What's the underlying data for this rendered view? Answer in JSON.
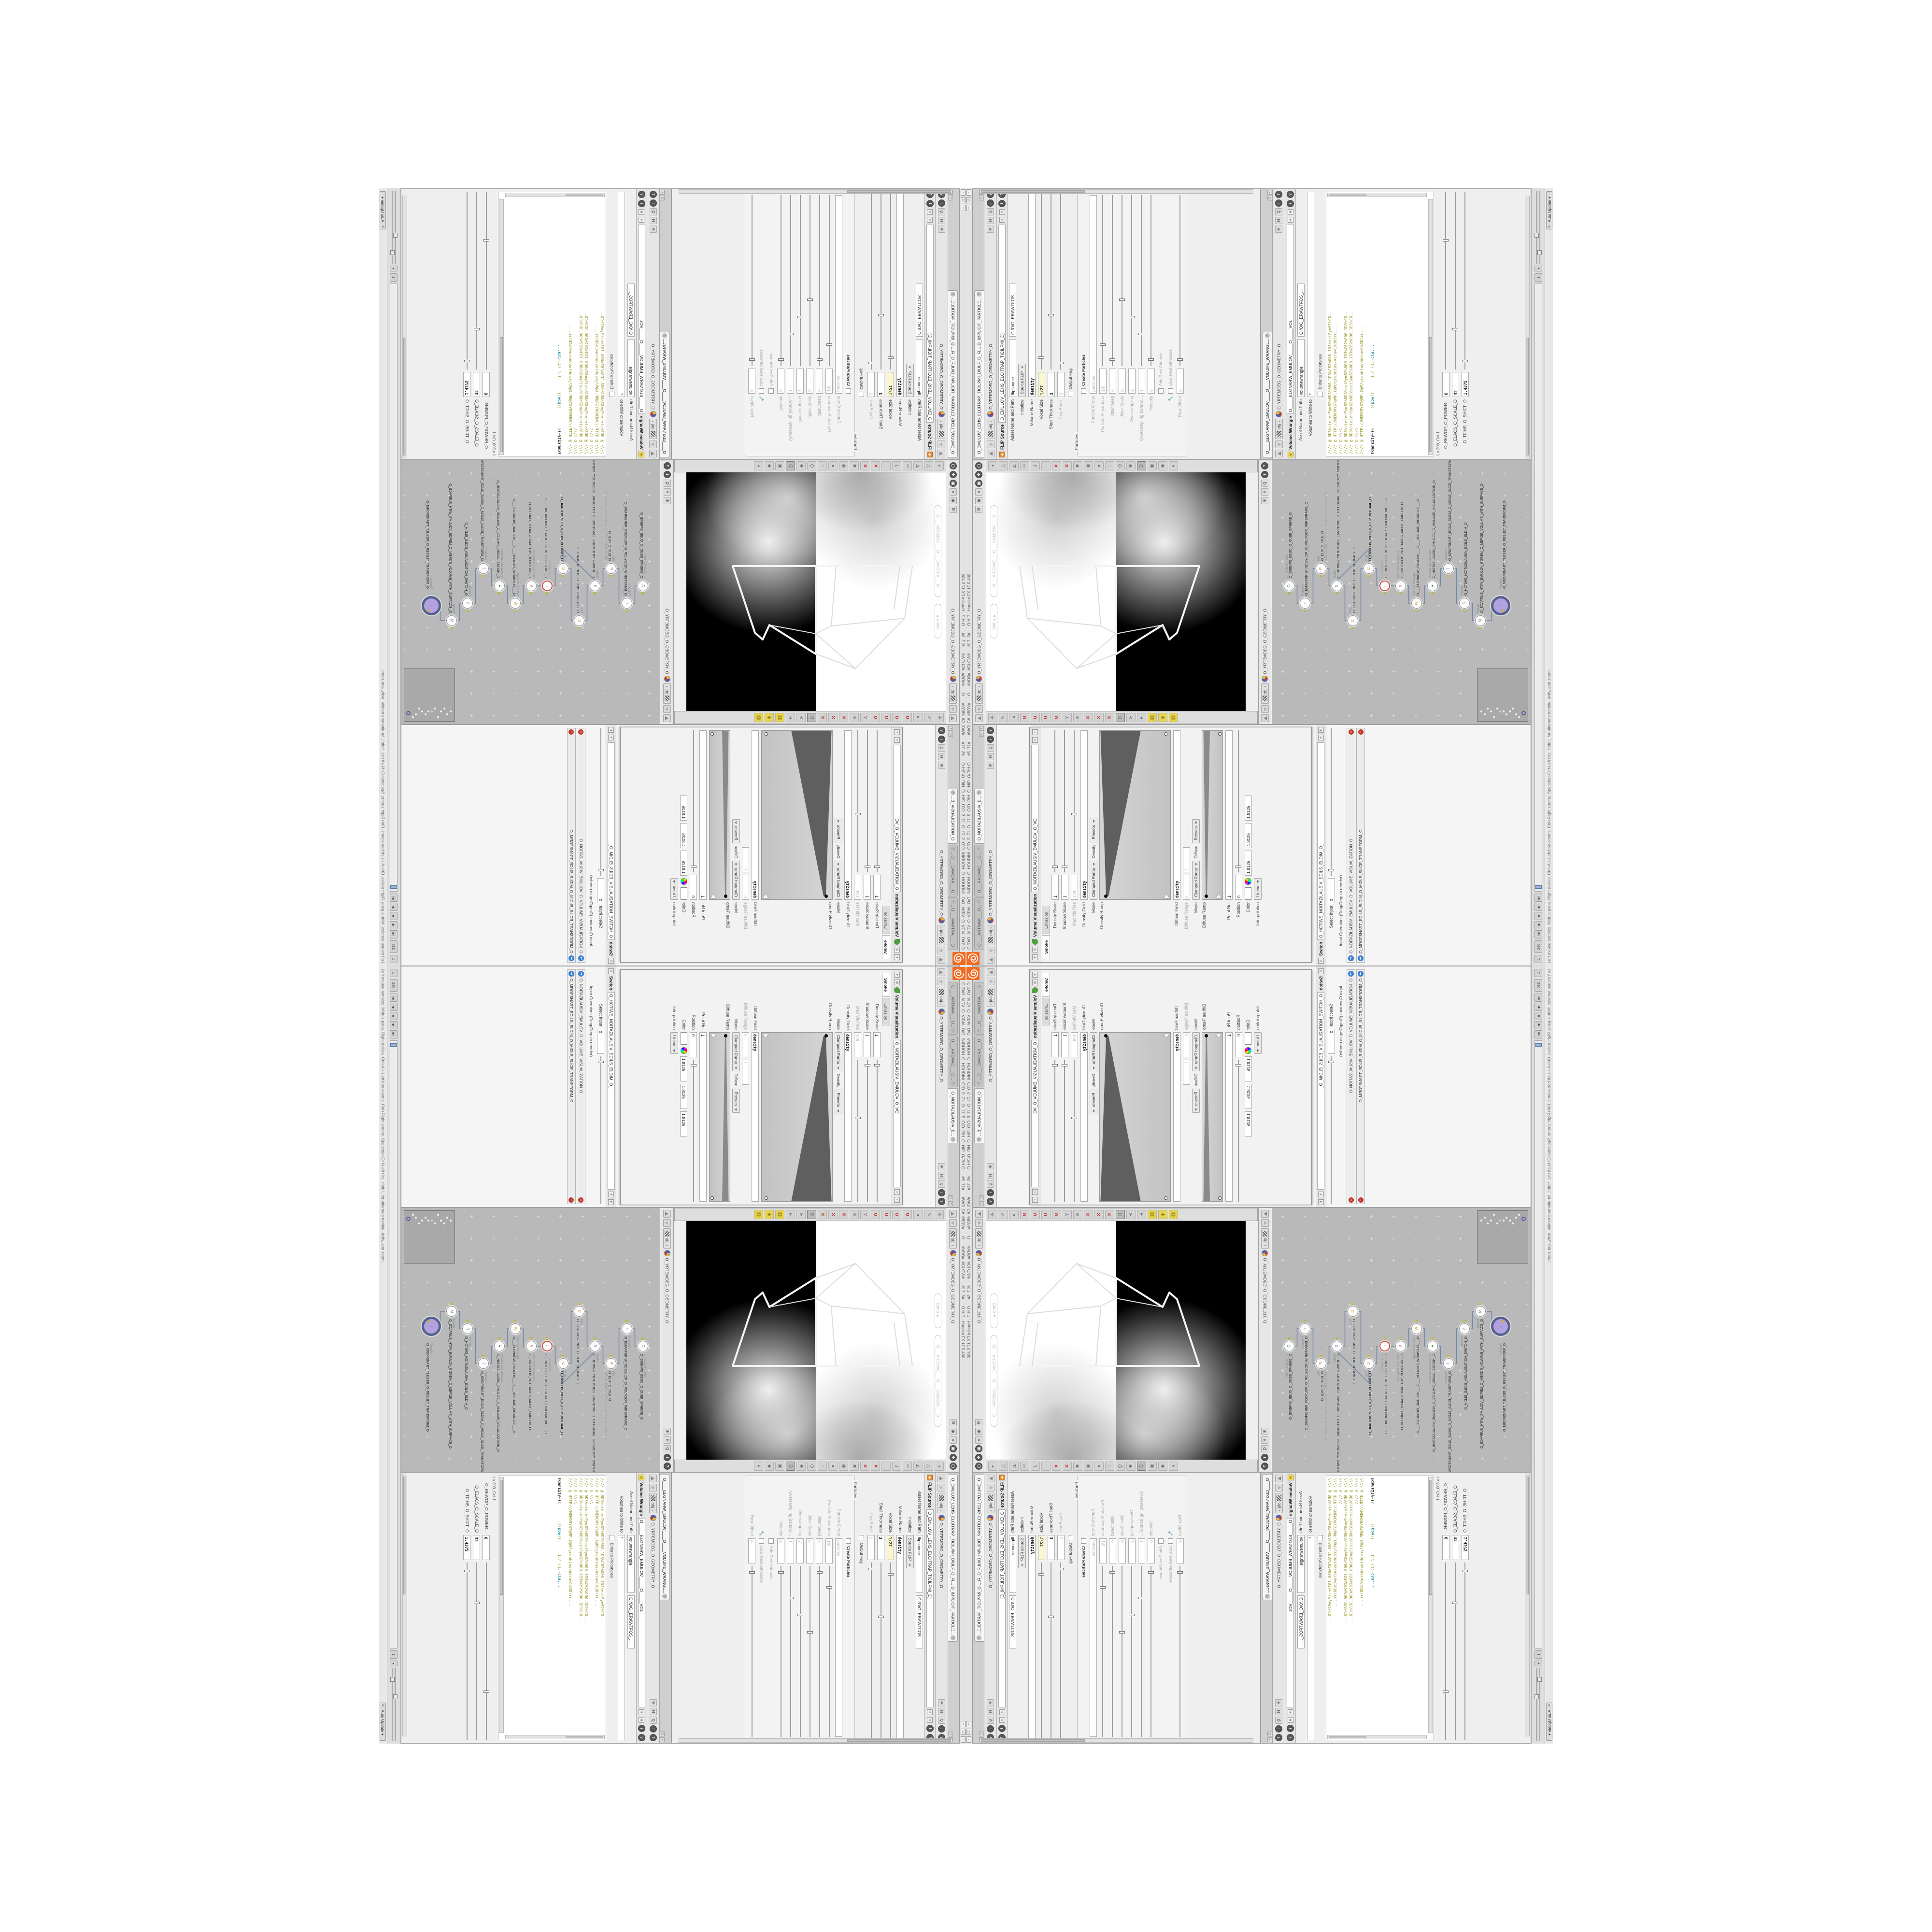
{
  "window": {
    "title": "C:/O/O_AIDV_O_VIDIA_O/O_INIDUOH_O_HOUDINI_O/O_5_71_O_17_5_O/O_PIH_O_HIP_O/PIH.O___#5_71#___#WOLG#_#BDV#___O___#VDB#_#GLOW#___#17_5#___O.HIP - Houdini FX 17.5.480",
    "buttons": {
      "min": "–",
      "max": "▢",
      "close": "×"
    },
    "logo": "houdini-logo"
  },
  "status": {
    "help": "Left mouse tumbles.  Middle pans.  Right dollies.  Ctrl+Alt+Left box-zooms.  Ctrl+Right zooms.  Spacebar-Ctrl-Left tilts.  Hold L for alternate tumble, dolly, and zoom.",
    "auto_update": "Auto Update"
  },
  "playbar": {
    "start": "1",
    "end": "240",
    "current": "1",
    "transport": [
      "|◀",
      "◀",
      "■",
      "▶",
      "▶|"
    ]
  },
  "breadcrumb": {
    "net": "obj",
    "node": "O_YRTEMOEG_O_GEOMETRY_O",
    "pin": "*"
  },
  "pane_icons": [
    "✳",
    "H",
    "Q",
    "i",
    "?"
  ],
  "left_pane": {
    "tabs": [
      {
        "label": "O ___ARTNAM___O...",
        "active": false
      },
      {
        "label": "O___AREMAC___O...",
        "active": false
      },
      {
        "label": "O_NOITAZILAUSIV_E...",
        "active": true
      }
    ],
    "vv_window": {
      "title": "Volume Visualization",
      "name_field": "O_NOITAZILAUSIV_EMULOV_O_VO",
      "tabs": [
        "Smoke",
        "Emission"
      ],
      "rows": [
        {
          "t": "fs",
          "label": "Density Scale",
          "value": "1",
          "p": 3
        },
        {
          "t": "fs",
          "label": "Shadow Scale",
          "value": "1",
          "p": 3
        },
        {
          "t": "fs",
          "label": "Max Vis Res",
          "value": "128",
          "dis": true,
          "p": 40
        },
        {
          "t": "fv",
          "label": "Density Field",
          "value": "density",
          "bold": true
        },
        {
          "t": "mode",
          "label": "Mode",
          "value": "Clamped Ramp",
          "mid": "Density",
          "btn": "Presets"
        },
        {
          "t": "ramp",
          "label": "Density Ramp",
          "h": 148,
          "big": true
        },
        {
          "t": "fv",
          "label": "Diffuse Field",
          "value": "density",
          "bold": true
        },
        {
          "t": "f2",
          "label": "Diffuse Range",
          "v1": "0",
          "v2": "1",
          "dis": true
        },
        {
          "t": "mode",
          "label": "Mode",
          "value": "Clamped Ramp",
          "mid": "Diffuse",
          "btn": "Presets"
        },
        {
          "t": "ramp",
          "label": "Diffuse Ramp",
          "h": 44,
          "big": false
        },
        {
          "t": "fv",
          "label": "Point No.",
          "value": "1"
        },
        {
          "t": "fs",
          "label": "Position",
          "value": "0",
          "p": 3
        },
        {
          "t": "color",
          "label": "Color",
          "r": "1.8125",
          "g": "1.8125",
          "b": "1.8125"
        },
        {
          "t": "sel",
          "label": "Interpolation",
          "value": "Linear"
        }
      ]
    },
    "switch_section": {
      "title": "Switch",
      "name_field": "O_HCTIWS_NOITAZILAUSIV_ECILS_ELDIM_O_",
      "rows": [
        {
          "t": "fs",
          "label": "Select Input",
          "value": "0",
          "p": 3
        },
        {
          "t": "label",
          "label": "Input Operators (Drag/Drop to reorder)"
        },
        {
          "t": "oprow",
          "label": "O_NOITAZILAUSIV_EMULOV_O_VOLUME_VISUALIZATION_O"
        },
        {
          "t": "oprow",
          "label": "O_MROFSNART_ECILS_ELDIM_O_MIDLE_SLICE_TRANSFORM_O"
        }
      ]
    }
  },
  "viewport": {
    "view_pill": "Ortho ▾",
    "camera_pill": "O___AREMAC___O___CAMERA___O",
    "right_icon_stack": [
      "⚒",
      "◉",
      "●",
      "▣",
      "❖",
      "▢"
    ],
    "left_tools": [
      "✇",
      "✎",
      "◂",
      "∪",
      "∪",
      "∪",
      "∪",
      "Y",
      "✳",
      "✕",
      "✕",
      "✕",
      "D",
      "➤",
      "▸",
      "▥",
      "◈",
      "▥"
    ],
    "right_tools": [
      "◂",
      "△",
      "◭",
      "✂",
      "⚷",
      "·",
      "✕",
      "✕",
      "✹",
      "◉",
      "●",
      "○",
      "Q",
      "✹",
      "D",
      "▣",
      "◆",
      "▸"
    ]
  },
  "network": {
    "nodes": [
      {
        "type": "an_CubeSphere",
        "name": "O_EREHPS_EBUC_O_CUBE_SPHERE_O",
        "icon": "G",
        "c": "#3f9e4f",
        "lane": 1
      },
      {
        "type": "PolyWire",
        "name": "O_EMARFERIW_NOGYLOP_O_POLYGON_WIREFRAME_O",
        "icon": "+",
        "c": "#888",
        "lane": 0
      },
      {
        "type": "File",
        "name": "O_ELIF_O_FILE_O",
        "sub": "JRO.NO1.PETS.TRIPL5_O_5LPIRT.STEP.1ON.ORJ",
        "icon": "F",
        "c": "#c44e3c",
        "lane": 2
      },
      {
        "type": "Switch",
        "name": "O_HCTIWS_YRTEMOEG_LANRETXE_O_EXTERNAL_GEOMETRY_SWITCH_O",
        "icon": "S",
        "c": "#888",
        "lane": 1
      },
      {
        "type": "Clip",
        "name": "O_ECAFRUS_PILC_O_CLIP_SURFACE_O",
        "icon": "C",
        "c": "#e08a2e",
        "lane": -1
      },
      {
        "type": "Clip",
        "name": "O_EMULOV_PILC_O_CLIP_VOLUME_O",
        "icon": "C",
        "c": "#e08a2e",
        "lane": 2,
        "bold": true
      },
      {
        "type": "FLIP Source",
        "name": "O_EMULOV_LEHS_ELCITRAP_TICILPMI_DIULF_O",
        "icon": "◌",
        "c": "#cf4f44",
        "lane": 1,
        "redring": true
      },
      {
        "type": "VDB from Polygons",
        "name": "O_SNOGILOP_YRTEMOEG_MORF_EMULOV_O",
        "icon": "V",
        "c": "#c44e3c",
        "lane": 1
      },
      {
        "type": "Volume Wrangle",
        "name": "O___ELGNARW_EMULOV___O___VOLUME_WRANGLE___O",
        "icon": "W",
        "c": "#b8a12c",
        "lane": 0
      },
      {
        "type": "Volume Visualization",
        "name": "O_NOITAZILAUSIV_EMULOV_O_VOLUME_VISUALIZATION_O",
        "icon": "●",
        "c": "#3f7e3f",
        "lane": 1
      },
      {
        "type": "Transform",
        "name": "O_MROFSNART_ECILS_ELDIM_O_MIDLE_SLICE_TRANSFORM_O",
        "icon": "T",
        "c": "#6a7fc0",
        "lane": 2
      },
      {
        "type": "Switch",
        "name": "O_HCTIWS_NOITAZILAUSIV_ECILS_ELDIM_O",
        "icon": "S",
        "c": "#888",
        "lane": 0
      },
      {
        "type": "Merge",
        "name": "O_ECAFRUS_HTIW_EMULOV_EGREM_O_MERGE_VOLUME_WITH_SURFACE_O",
        "icon": "M",
        "c": "#888",
        "lane": -1
      },
      {
        "type": "Transform",
        "name": "O_MROFSNART_TLUSER_O_RESULT_TRANSFORM_O",
        "icon": "T",
        "c": "#6a7fc0",
        "lane": 0,
        "big": true
      }
    ]
  },
  "flip_pane": {
    "tab": "O_EMULOV_LEHS_ELCITRAP_TICILPMI_DIULF_O_FLUID_IMPLICIT_PARTICLE...",
    "title": "FLIP Source",
    "name_field": "O_EMULOV_LEHS_ELCITRAP_TICILPMI_D]",
    "asset_label": "Asset Name and Path",
    "asset_name": "flipsource",
    "asset_path": "C:/O/O_ERAWTFOS_...",
    "rows": [
      {
        "t": "sel",
        "label": "Initialize",
        "value": "Source FLIP"
      },
      {
        "t": "fv",
        "label": "Volume Name",
        "value": "density",
        "bold": true
      },
      {
        "t": "fs",
        "label": "Voxel Size",
        "value": "1/27",
        "bold": true,
        "expr": true,
        "p": 6
      },
      {
        "t": "fs",
        "label": "Shell Thickness",
        "value": "3",
        "bold": true,
        "p": 30
      },
      {
        "t": "fs",
        "label": "Fog Boost",
        "value": "0",
        "dis": true,
        "p": 3
      },
      {
        "t": "check",
        "label": "Output Fog",
        "on": false
      }
    ],
    "group_title": "Particles",
    "group_rows": [
      {
        "t": "check",
        "label": "Create Particles",
        "on": false,
        "bold": true
      },
      {
        "t": "fv",
        "label": "Particle Group",
        "value": "particles",
        "dis": true
      },
      {
        "t": "fs",
        "label": "Particle Separation",
        "value": "1/9",
        "dis": true,
        "p": 12
      },
      {
        "t": "fs",
        "label": "Jitter Seed",
        "value": "0",
        "dis": true,
        "p": 3
      },
      {
        "t": "fs",
        "label": "Jitter Scale",
        "value": "0",
        "dis": true,
        "p": 38
      },
      {
        "t": "fs",
        "label": "Oversampling",
        "value": "2",
        "dis": true,
        "p": 28
      },
      {
        "t": "fs",
        "label": "Oversampling Bandwi...",
        "value": "1",
        "dis": true,
        "p": 18
      },
      {
        "t": "fs",
        "label": "Velocity",
        "value": "0",
        "dis": true,
        "p": 3
      },
      {
        "t": "check",
        "label": "Add Rest Attribute",
        "on": false,
        "dis": true
      },
      {
        "t": "check",
        "label": "Dual Rest Attributes",
        "on": false,
        "dis": true,
        "wrench": true
      },
      {
        "t": "fs",
        "label": "Rest Offset",
        "value": "0",
        "dis": true,
        "p": 3
      }
    ]
  },
  "wrangle_pane": {
    "tab": "O____ELGNARW_EMULOV____O____VOLUME_WRANGL...",
    "title": "Volume Wrangle",
    "name_field": "O_____ELGNARW_EMULOV_____O_____VOL",
    "asset_label": "Asset Name and Path",
    "asset_name": "volumewrangle",
    "asset_path": "C:/O/O_ERAWTFOS_...",
    "rows_top": [
      {
        "t": "fv",
        "label": "Volumes to Write to",
        "value": "*"
      },
      {
        "t": "check",
        "label": "Enforce Prototypes",
        "on": false
      }
    ],
    "code_lines": [
      "//// @ 0D3%steserPym62%0D3%000.1D3%C62%000.1D3%eziSym62%C0...",
      "//// @ HTTP://MEMORYST@MP.C@M/graphtoy/#draw1%3Dtru...",
      "//// @ \\\\\\\\",
      "//// @ 0D3%steserPym62%0D3%eziSym62%000.1D3%C62%000.1D3%C0...",
      "//// @ 0D3%steserPym62%0D3%eziSym62%000.1D3%C62%000.1D3%C0...",
      "//// @ \\\\\\\\",
      "//// @ HTTP://MEMORYST@MP.C@M/graphtoy/#draw1%3Dtru...",
      "",
      "@density=((        ((pow((      1./ (1.-cla..."
    ],
    "ln_col": "Ln 209, Col 1",
    "sliders": [
      {
        "t": "fs",
        "label": "O_REWOP_O_POWER...",
        "value": "6",
        "bold": true,
        "p": 72
      },
      {
        "t": "fs",
        "label": "O_ELACS_O_SCALE_O",
        "value": "32",
        "bold": true,
        "p": 22
      },
      {
        "t": "fs",
        "label": "O_TFIHS_O_SHIFT_O",
        "value": "1.4375",
        "bold": true,
        "p": 4
      }
    ]
  }
}
